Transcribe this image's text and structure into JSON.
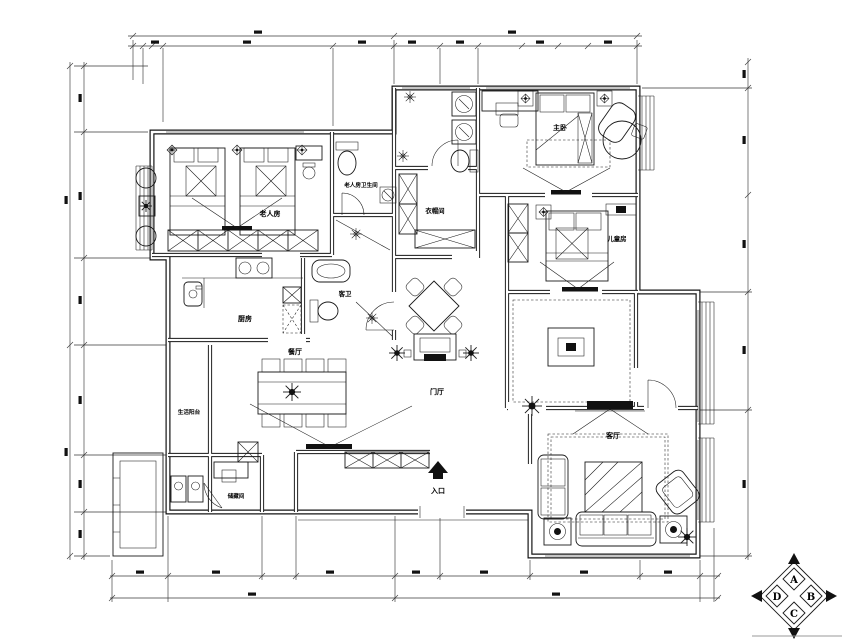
{
  "labels": {
    "elder_bedroom": "老人房",
    "elder_bathroom": "老人房卫生间",
    "cloakroom": "衣帽间",
    "master_bedroom": "主卧",
    "kids_room": "儿童房",
    "kitchen": "厨房",
    "guest_bath": "客卫",
    "dining": "餐厅",
    "foyer": "门厅",
    "living": "客厅",
    "service_balcony": "生活阳台",
    "storage": "储藏间",
    "entrance": "入口"
  },
  "compass": {
    "top": "A",
    "right": "B",
    "bottom": "C",
    "left": "D"
  },
  "colors": {
    "line": "#1a1a1a",
    "background": "#ffffff"
  }
}
